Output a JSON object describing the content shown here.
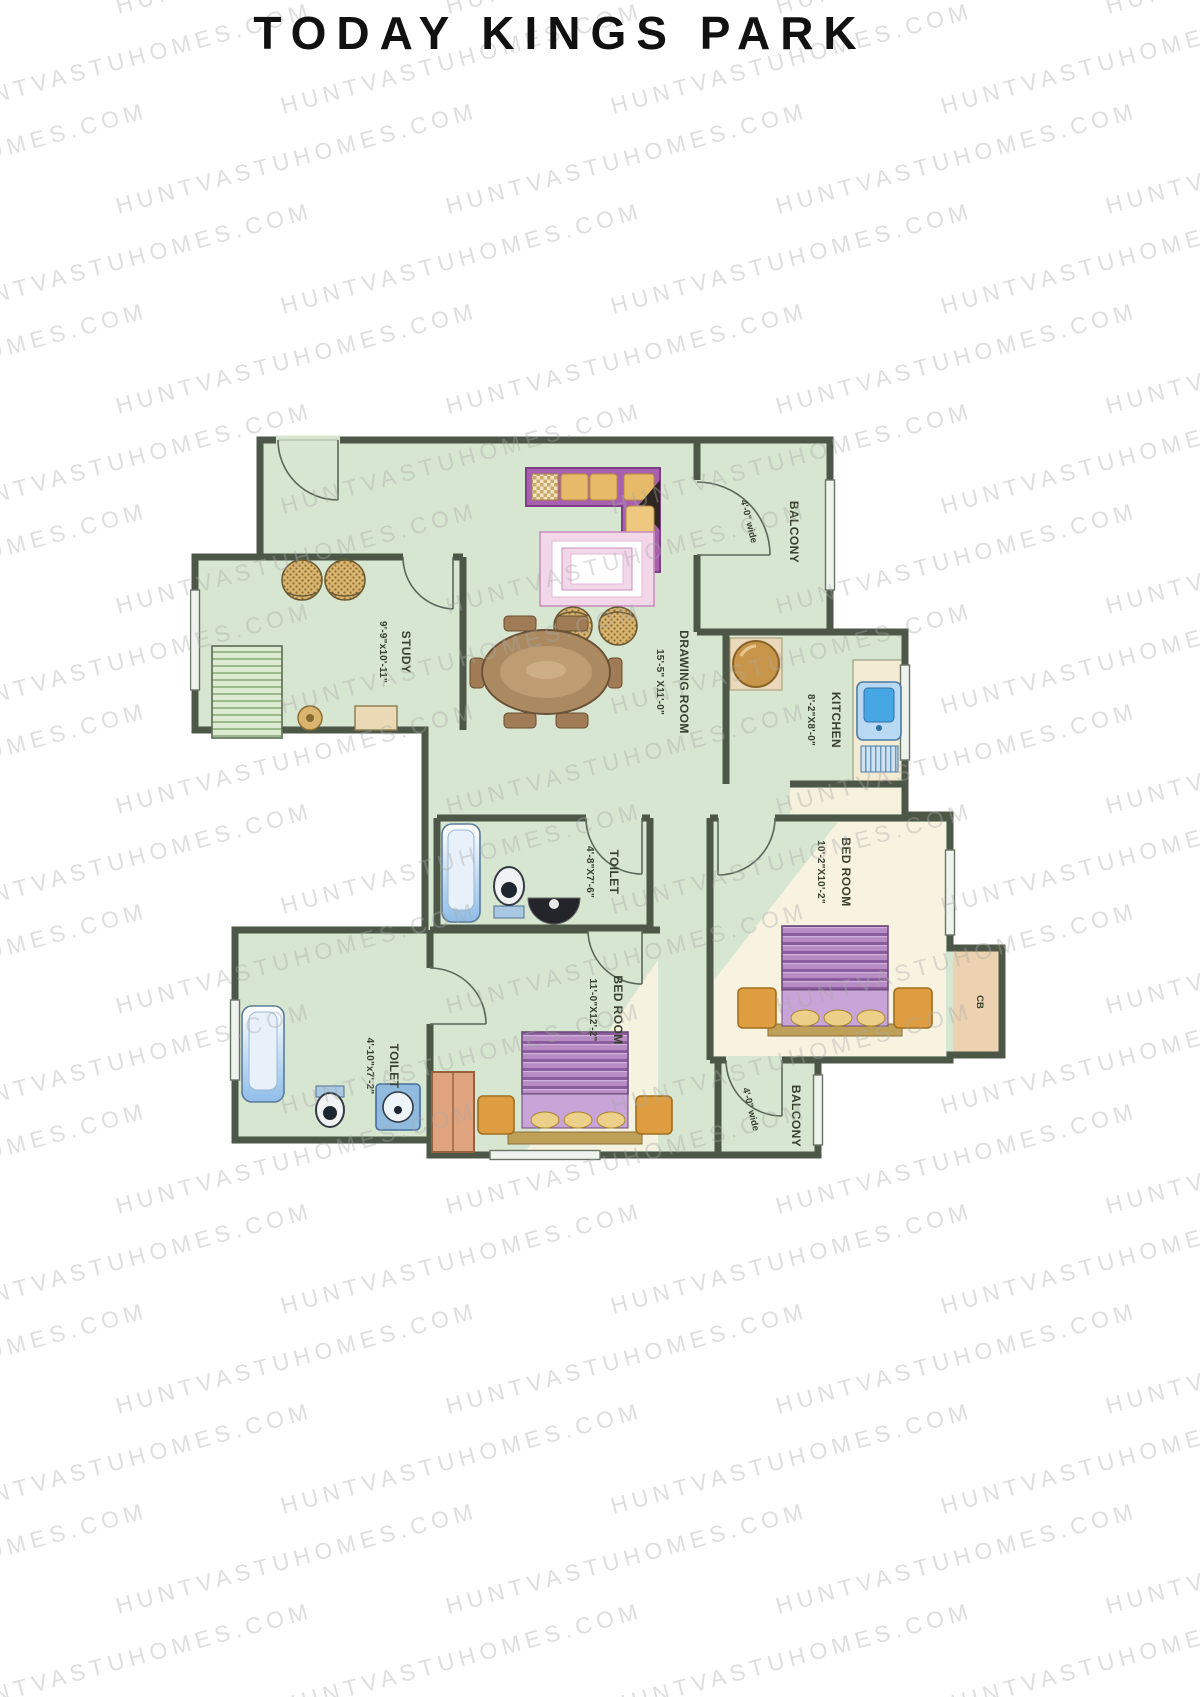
{
  "title": "TODAY KINGS PARK",
  "watermark": {
    "text": "HUNTVASTUHOMES.COM"
  },
  "plan": {
    "rooms": {
      "study": {
        "name": "STUDY",
        "dimensions": "9'-9\"x10'-11\""
      },
      "drawing_room": {
        "name": "DRAWING ROOM",
        "dimensions": "15'-5\" X11'-0\""
      },
      "balcony_top": {
        "name": "BALCONY",
        "width_note": "4'-0\" wide"
      },
      "kitchen": {
        "name": "KITCHEN",
        "dimensions": "8'-2\"X8'-0\""
      },
      "toilet_middle": {
        "name": "TOILET",
        "dimensions": "4'-8\"X7'-6\""
      },
      "bedroom_right": {
        "name": "BED ROOM",
        "dimensions": "10'-2\"X10'-2\""
      },
      "cupboard": {
        "name": "CB"
      },
      "balcony_bottom": {
        "name": "BALCONY",
        "width_note": "4'-0\" wide"
      },
      "bedroom_bottom": {
        "name": "BED ROOM",
        "dimensions": "11'-0\"X12'-2\""
      },
      "toilet_bottom": {
        "name": "TOILET",
        "dimensions": "4'-10\"x7'-2\""
      }
    },
    "colors": {
      "title_ink": "#111111",
      "label_ink": "#38402e",
      "floor": "#d7e6d0",
      "cream": "#f8f3e0",
      "wall": "#4d5748",
      "sofa_magenta": "#a85fae",
      "cushion_tan": "#e6ba68",
      "rug_pink": "#f2d7e9",
      "wood_brown": "#ab8a62",
      "bed_purple": "#b78cc4",
      "nightstand_orange": "#de9d41",
      "sink_blue": "#46a5e3",
      "tub_blue": "#8fbde8",
      "counter_cream": "#f3ebd2",
      "wardrobe_salmon": "#e0a37f",
      "cupboard_tan": "#ecd2b0",
      "fridge_brown": "#c8964a"
    }
  }
}
